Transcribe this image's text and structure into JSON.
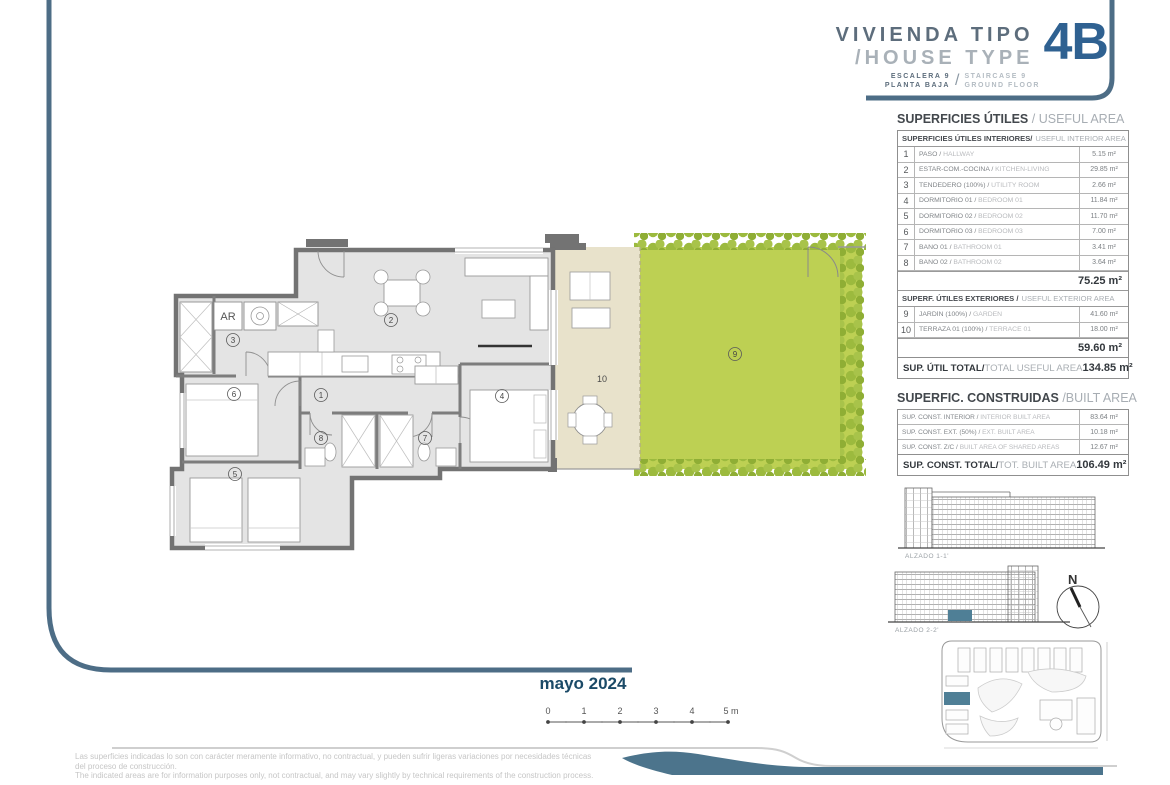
{
  "header": {
    "title_es": "VIVIENDA TIPO",
    "title_en": "/HOUSE TYPE",
    "unit": "4B",
    "stair_es": "ESCALERA 9",
    "floor_es": "PLANTA BAJA",
    "slash": "/",
    "stair_en": "STAIRCASE 9",
    "floor_en": "GROUND FLOOR"
  },
  "useful_area": {
    "title_es": "SUPERFICIES ÚTILES",
    "title_en": "/ USEFUL AREA",
    "interior": {
      "header_es": "SUPERFICIES ÚTILES INTERIORES/",
      "header_en": "USEFUL INTERIOR AREA",
      "rows": [
        {
          "num": "1",
          "es": "PASO /",
          "en": "HALLWAY",
          "area": "5.15 m²"
        },
        {
          "num": "2",
          "es": "ESTAR-COM.-COCINA /",
          "en": "KITCHEN-LIVING",
          "area": "29.85 m²"
        },
        {
          "num": "3",
          "es": "TENDEDERO (100%) /",
          "en": "UTILITY ROOM",
          "area": "2.66 m²"
        },
        {
          "num": "4",
          "es": "DORMITORIO 01 /",
          "en": "BEDROOM 01",
          "area": "11.84 m²"
        },
        {
          "num": "5",
          "es": "DORMITORIO 02 /",
          "en": "BEDROOM 02",
          "area": "11.70 m²"
        },
        {
          "num": "6",
          "es": "DORMITORIO 03 /",
          "en": "BEDROOM 03",
          "area": "7.00 m²"
        },
        {
          "num": "7",
          "es": "BAÑO 01 /",
          "en": "BATHROOM 01",
          "area": "3.41 m²"
        },
        {
          "num": "8",
          "es": "BAÑO 02 /",
          "en": "BATHROOM 02",
          "area": "3.64 m²"
        }
      ],
      "total": "75.25 m²"
    },
    "exterior": {
      "header_es": "SUPERF. ÚTILES EXTERIORES /",
      "header_en": "USEFUL EXTERIOR AREA",
      "rows": [
        {
          "num": "9",
          "es": "JARDÍN (100%) /",
          "en": "GARDEN",
          "area": "41.60 m²"
        },
        {
          "num": "10",
          "es": "TERRAZA 01 (100%) /",
          "en": "TERRACE 01",
          "area": "18.00 m²"
        }
      ],
      "total": "59.60 m²"
    },
    "grand_es": "SUP. ÚTIL TOTAL/",
    "grand_en": "TOTAL USEFUL AREA",
    "grand_total": "134.85 m²"
  },
  "built_area": {
    "title_es": "SUPERFIC. CONSTRUIDAS",
    "title_en": "/BUILT AREA",
    "rows": [
      {
        "es": "SUP. CONST. INTERIOR /",
        "en": "INTERIOR BUILT AREA",
        "area": "83.64 m²"
      },
      {
        "es": "SUP. CONST. EXT. (50%) /",
        "en": "EXT. BUILT AREA",
        "area": "10.18 m²"
      },
      {
        "es": "SUP. CONST. Z/C /",
        "en": "BUILT AREA OF SHARED AREAS",
        "area": "12.67 m²"
      }
    ],
    "grand_es": "SUP. CONST. TOTAL/",
    "grand_en": "TOT. BUILT AREA",
    "grand_total": "106.49 m²"
  },
  "plan": {
    "labels": {
      "r1": "1",
      "r2": "2",
      "r3": "3",
      "r4": "4",
      "r5": "5",
      "r6": "6",
      "r7": "7",
      "r8": "8",
      "r9": "9",
      "r10": "10",
      "ar": "AR"
    }
  },
  "elevations": {
    "alzado1": "ALZADO 1-1'",
    "alzado2": "ALZADO 2-2'"
  },
  "compass": {
    "label": "N"
  },
  "date": "mayo 2024",
  "scalebar": {
    "ticks": [
      "0",
      "1",
      "2",
      "3",
      "4",
      "5 m"
    ]
  },
  "disclaimer": {
    "line1": "Las superficies indicadas lo son con carácter meramente informativo, no contractual, y pueden sufrir ligeras variaciones por necesidades técnicas",
    "line2": "del proceso de construcción.",
    "line3": "The indicated areas are for information purposes only, not contractual, and may vary slightly by technical requirements of the construction process."
  },
  "colors": {
    "accent_frame": "#4d6d86",
    "unit_blue": "#2f6191",
    "date_navy": "#1b4a67",
    "garden_green": "#bdd053",
    "hedge_green": "#9cba3e",
    "terrace_beige": "#e8e2cb",
    "wall_gray": "#737373",
    "floor_gray": "#e4e4e4",
    "highlight_teal": "#4f7f96"
  }
}
